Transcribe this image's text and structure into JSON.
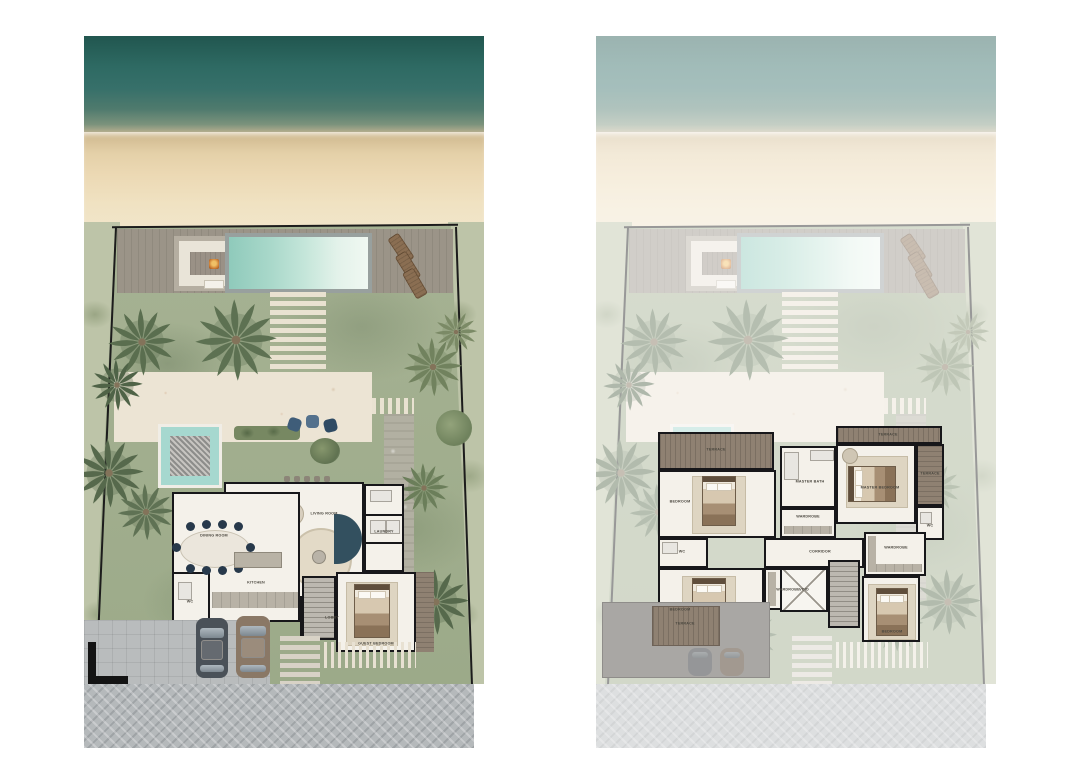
{
  "page": {
    "background": "#ffffff",
    "description": "Two beachfront villa colour site/floor plans side by side: ground floor with pool deck and garden (left), upper bedroom floor over faded site context (right)"
  },
  "colors": {
    "ocean": "#2e6a63",
    "sand": "#ecd9b4",
    "lawn": "#a2b08f",
    "edge_vegetation": "#bdc4a8",
    "pool_deck_wood": "#9b9488",
    "pool_water": "#a9d8ca",
    "plunge_pool": "#a6d8cf",
    "marble_patio": "#ece4d4",
    "interior_floor": "#f4f1ea",
    "wall": "#17171a",
    "terrace_wood": "#8f8172",
    "road_paving": "#b5b9bb",
    "car_dark": "#4a5158",
    "car_bronze": "#8a7866",
    "dining_chair_navy": "#27394b",
    "daybed_teal": "#33505f",
    "fire_bowl": "#c8762f"
  },
  "plans": {
    "ground": {
      "labels": {
        "dining": "DINING ROOM",
        "kitchen": "KITCHEN",
        "living": "LIVING ROOM",
        "lobby": "LOBBY",
        "wc": "WC",
        "laundry": "LAUNDRY",
        "guest_bedroom": "GUEST BEDROOM"
      }
    },
    "first": {
      "labels": {
        "terrace_a": "TERRACE",
        "terrace_b": "TERRACE",
        "terrace_c": "TERRACE",
        "terrace_e": "TERRACE",
        "bedroom_a": "BEDROOM",
        "bedroom_b": "BEDROOM",
        "bedroom_c": "BEDROOM",
        "master_bedroom": "MASTER BEDROOM",
        "master_bath": "MASTER BATH",
        "wardrobe_a": "WARDROBE",
        "wardrobe_b": "WARDROBE",
        "wardrobe_c": "WARDROBE",
        "wc_a": "WC",
        "wc_b": "WC",
        "corridor": "CORRIDOR",
        "void": "VOID"
      }
    }
  }
}
